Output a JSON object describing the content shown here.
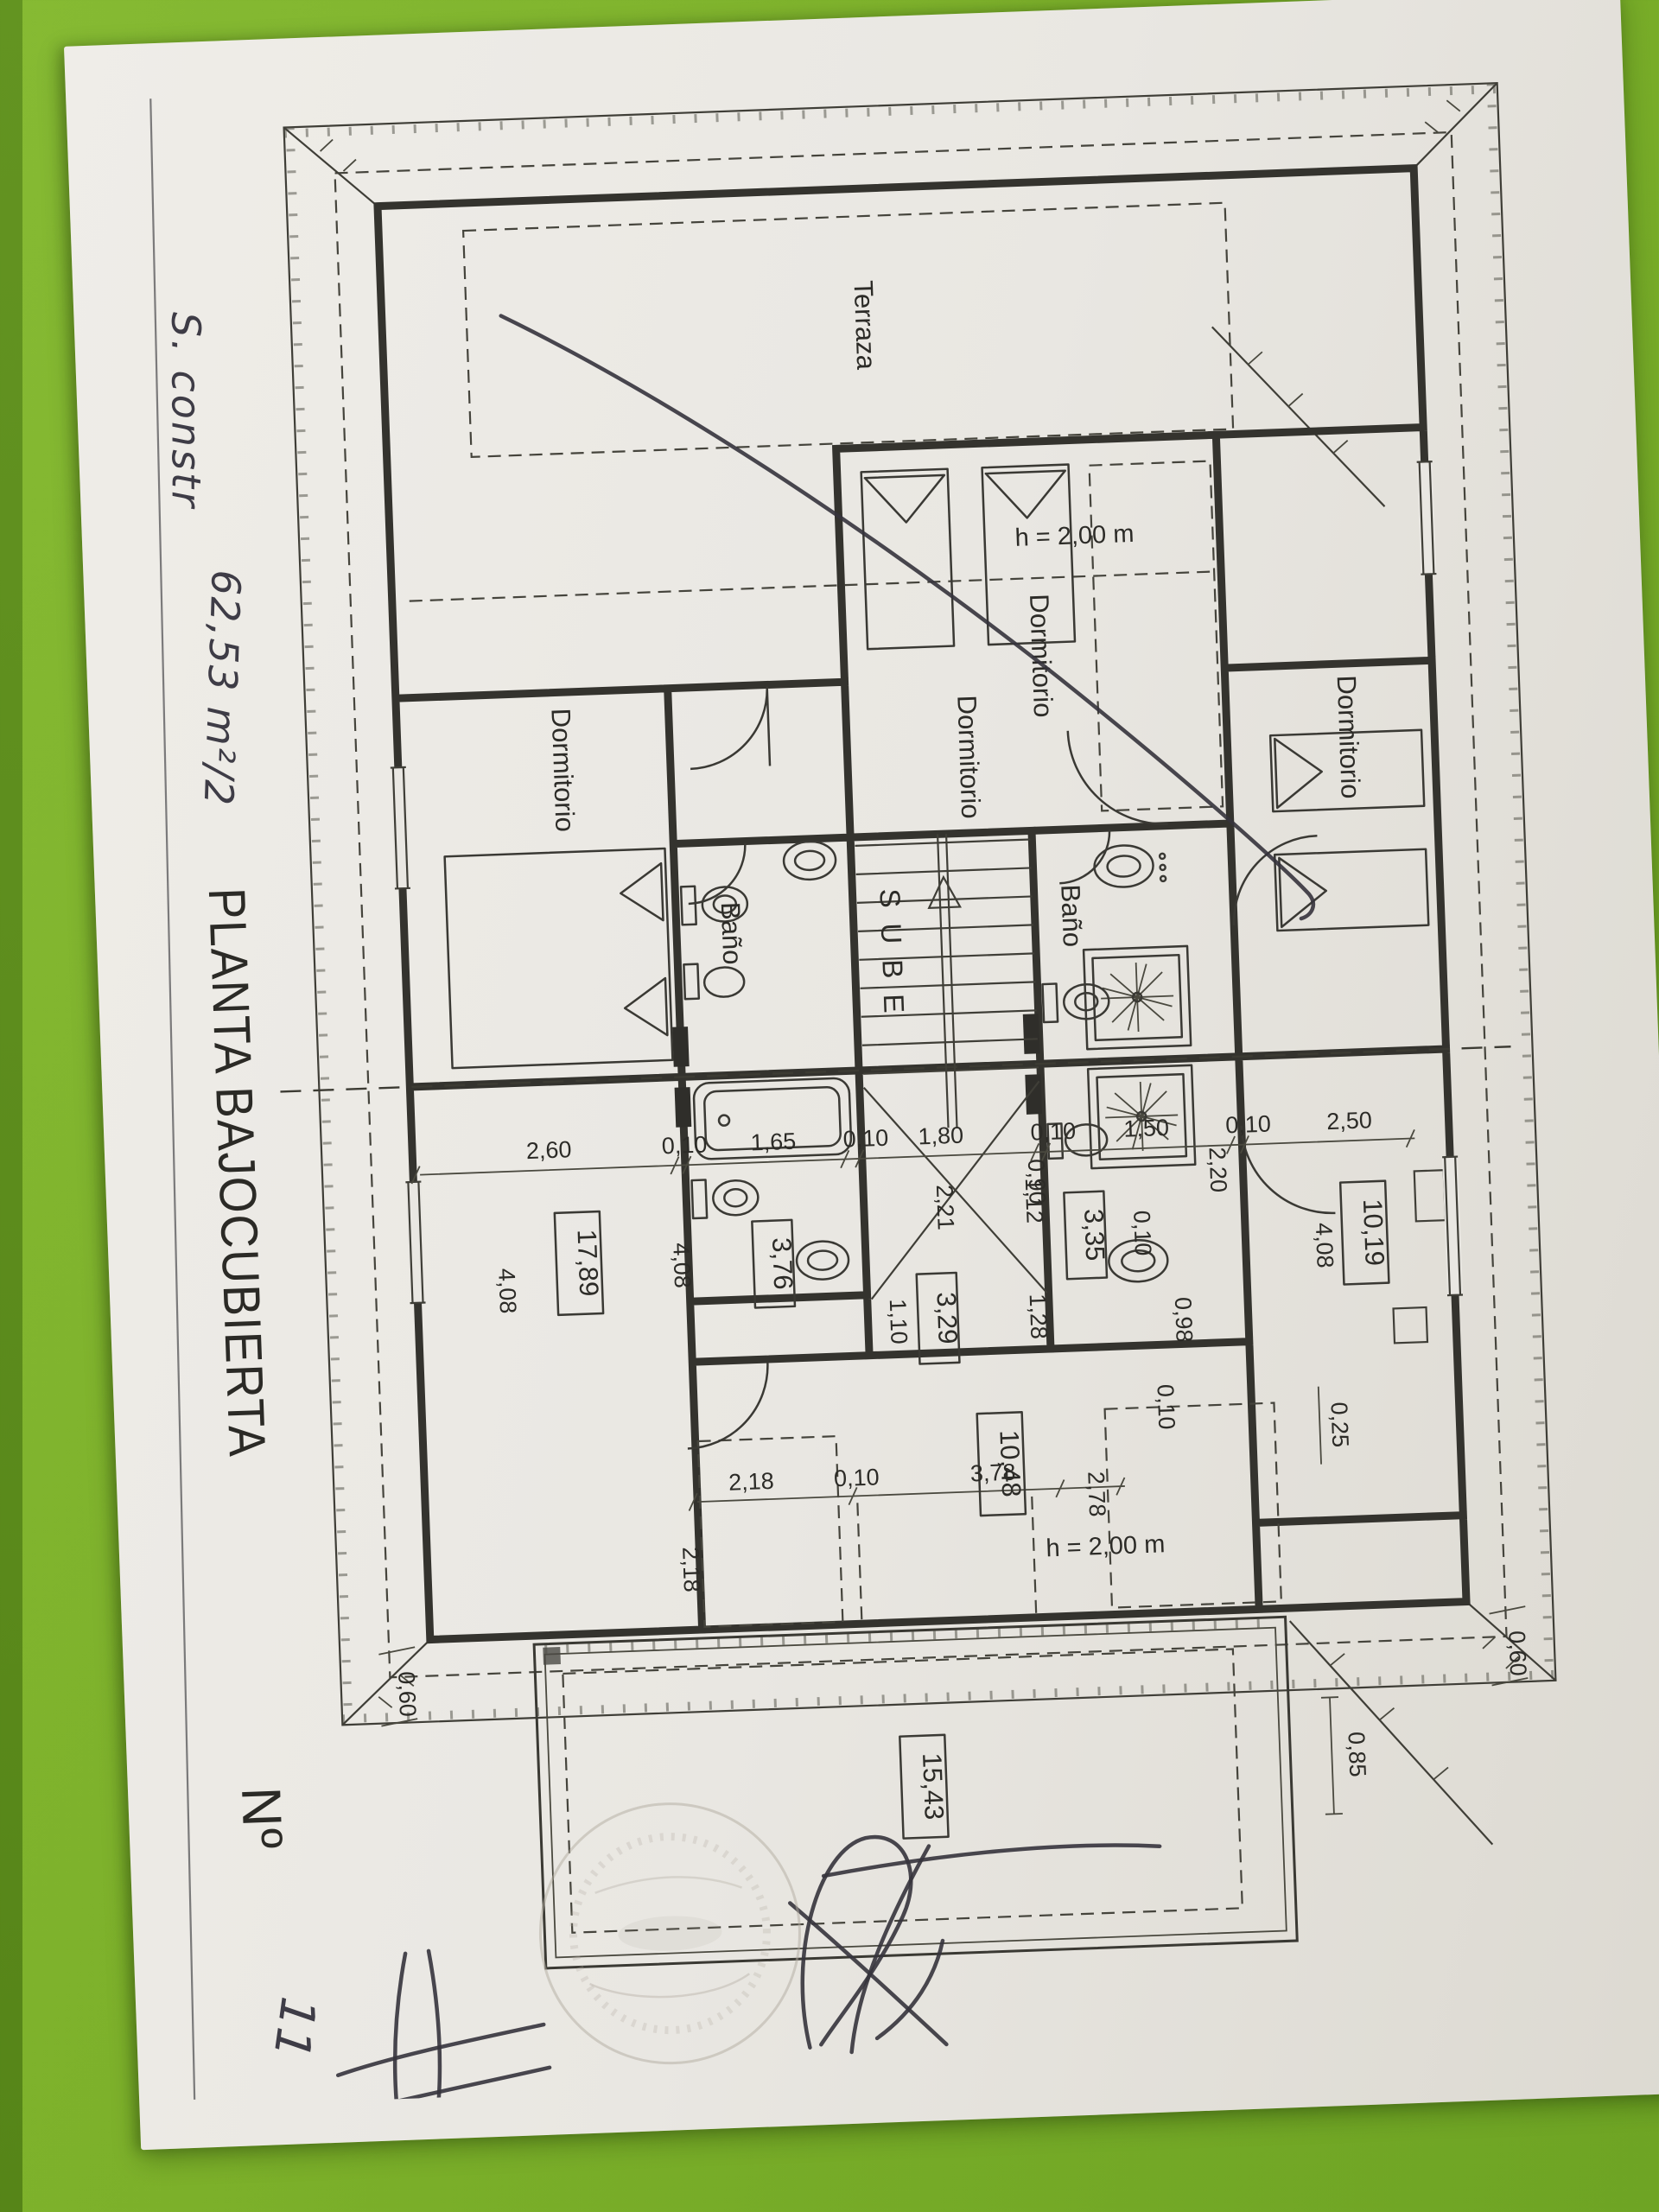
{
  "photo": {
    "background_color": "#7cb02a",
    "paper_color": "#e9e7e2"
  },
  "annotations": {
    "handwritten_note_line1": "S. constr",
    "handwritten_note_line2": "62,53 m²/2",
    "sheet_number_prefix": "Nº",
    "sheet_number_value": "11"
  },
  "title": "PLANTA BAJOCUBIERTA",
  "plan": {
    "room_labels": {
      "terraza": "Terraza",
      "dormitorio": "Dormitorio",
      "bano": "Baño",
      "stairs_up": "SUBE",
      "height_note": "h = 2,00 m"
    },
    "area_boxes": {
      "left_room": "17,89",
      "left_bath": "3,76",
      "left_hall": "3,29",
      "right_hall": "3,35",
      "right_room": "10,19",
      "bottom_room": "10,48",
      "bottom_terrace": "15,43"
    },
    "dims": {
      "d260": "2,60",
      "d010": "0,10",
      "d165": "1,65",
      "d180": "1,80",
      "d090": "0,90",
      "d150": "1,50",
      "d250": "2,50",
      "d408": "4,08",
      "d221": "2,21",
      "d112": "1,12",
      "d128": "1,28",
      "d110": "1,10",
      "d220": "2,20",
      "d098": "0,98",
      "d025": "0,25",
      "d218": "2,18",
      "d378": "3,78",
      "d278": "2,78",
      "d060": "0,60",
      "d085": "0,85"
    }
  }
}
